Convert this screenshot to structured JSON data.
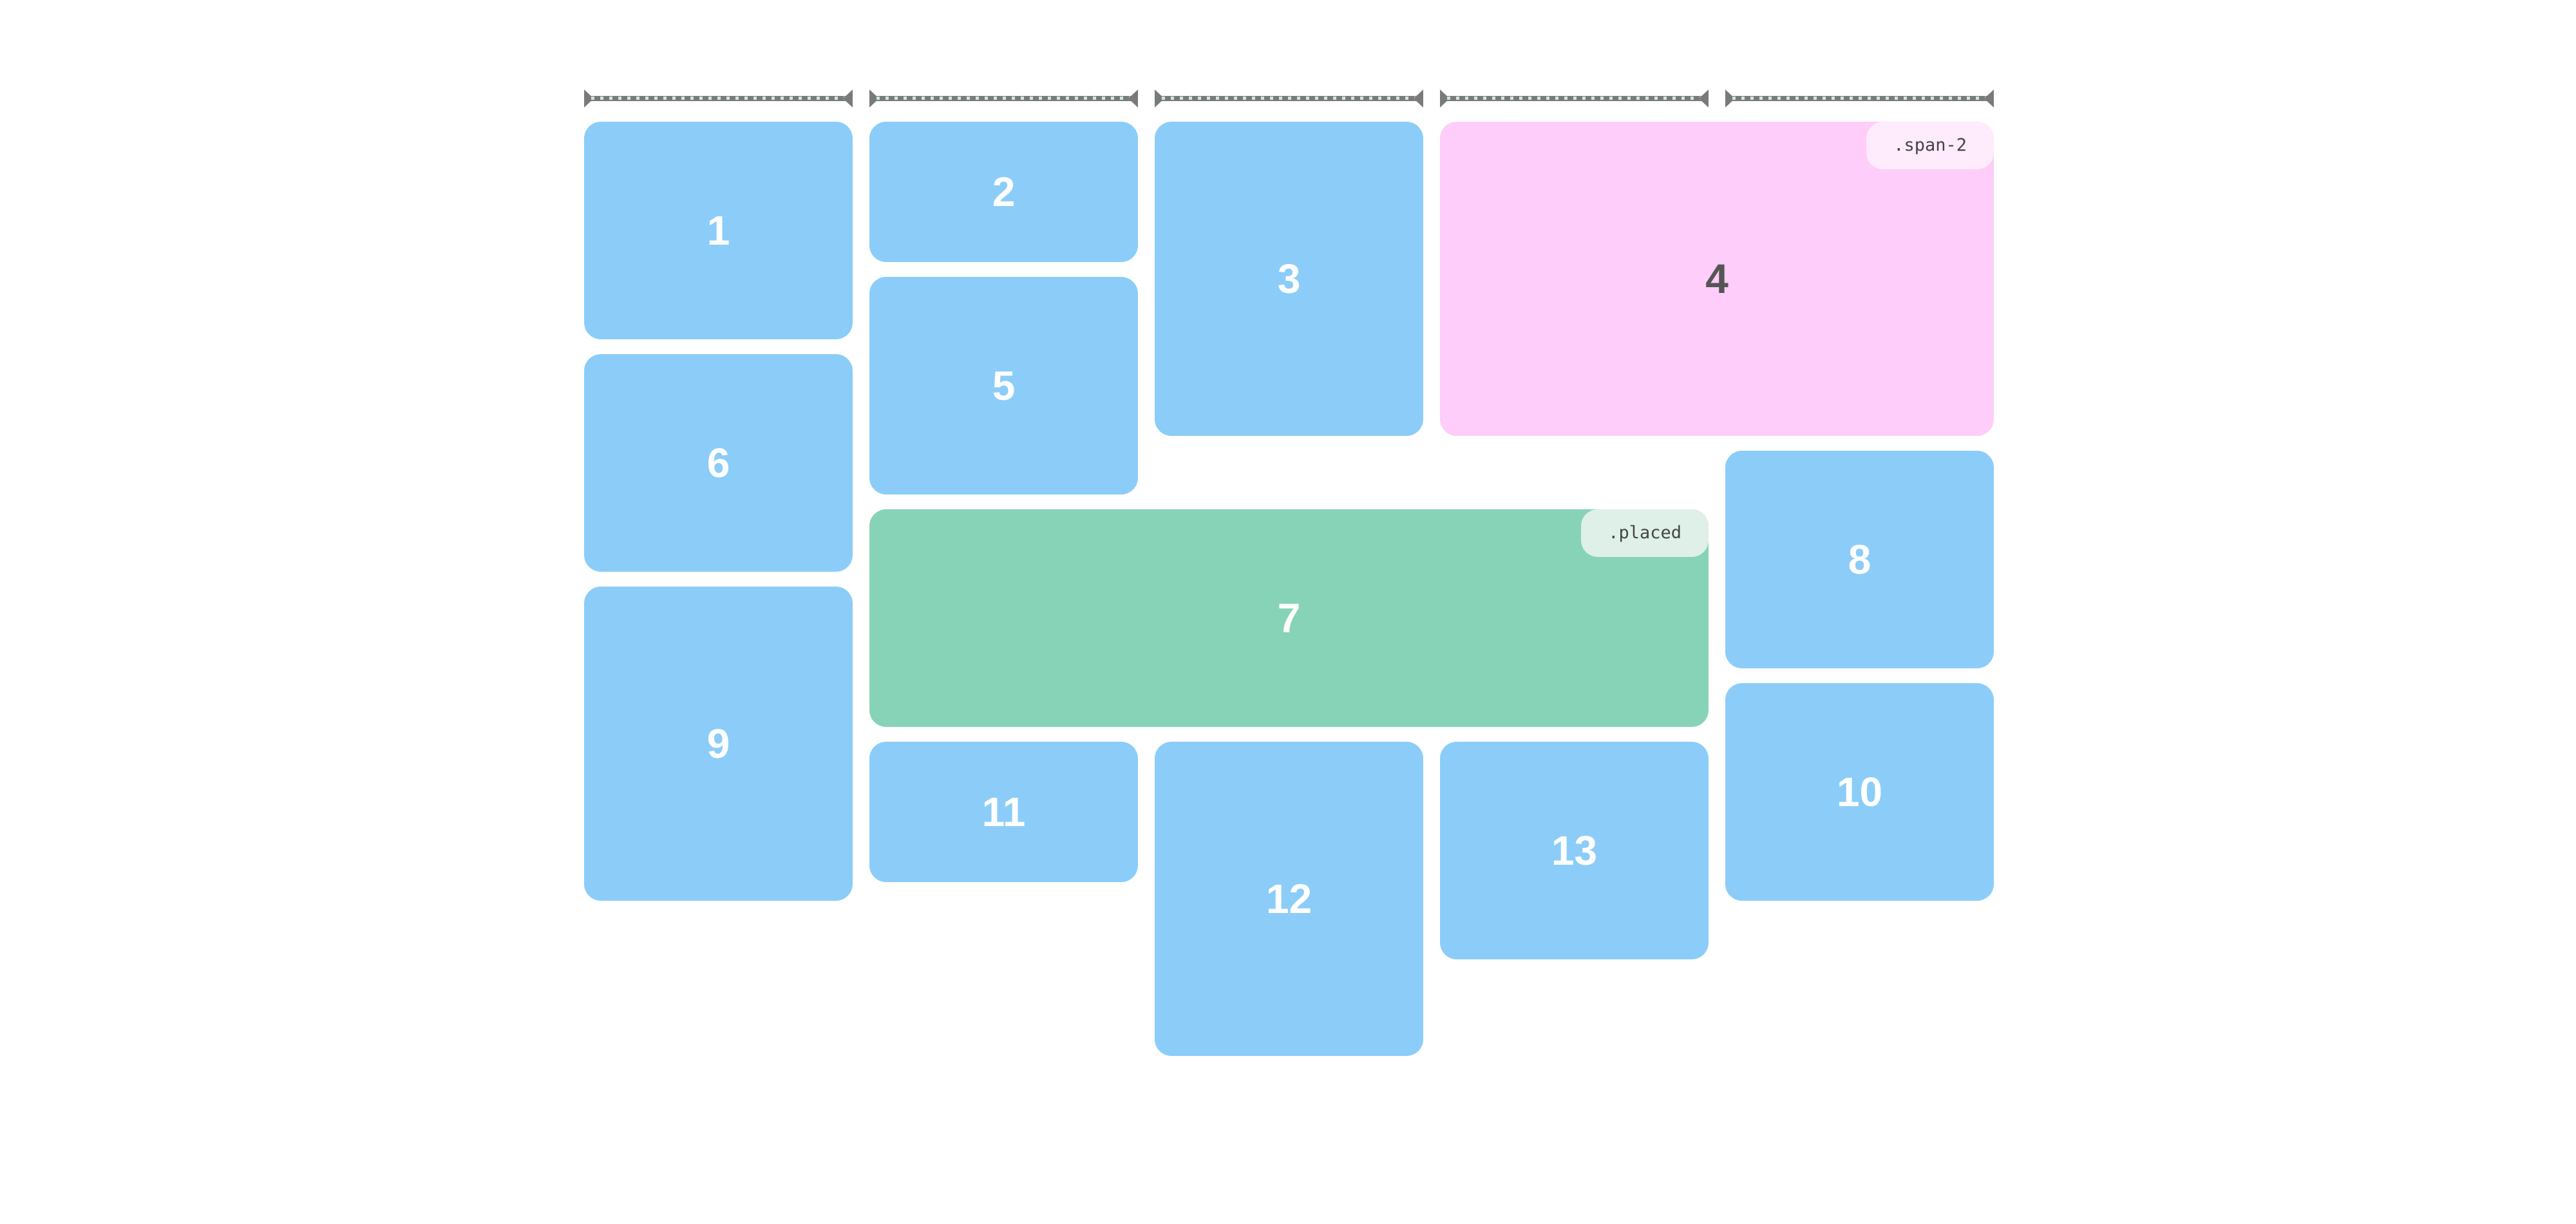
{
  "page": {
    "background": "#ffffff",
    "description": "CSS masonry grid layout demo with 13 numbered tiles and column width rulers"
  },
  "colors": {
    "item_blue": "#8bcdf8",
    "item_green": "#87d3b8",
    "item_pink": "#fecdf9",
    "badge_pink_bg": "#feebfc",
    "badge_mint_bg": "#def0e8",
    "badge_text": "#444444",
    "number_text": "#ffffff",
    "ruler_bar": "#7a7a7a",
    "ruler_dots": "#cde8df"
  },
  "ruler": {
    "segments": 5,
    "icon": "measure-arrow"
  },
  "items": [
    {
      "label": "1",
      "variant": "blue"
    },
    {
      "label": "2",
      "variant": "blue"
    },
    {
      "label": "3",
      "variant": "blue"
    },
    {
      "label": "4",
      "variant": "pink",
      "badge": ".span-2"
    },
    {
      "label": "5",
      "variant": "blue"
    },
    {
      "label": "6",
      "variant": "blue"
    },
    {
      "label": "7",
      "variant": "green",
      "badge": ".placed"
    },
    {
      "label": "8",
      "variant": "blue"
    },
    {
      "label": "9",
      "variant": "blue"
    },
    {
      "label": "10",
      "variant": "blue"
    },
    {
      "label": "11",
      "variant": "blue"
    },
    {
      "label": "12",
      "variant": "blue"
    },
    {
      "label": "13",
      "variant": "blue"
    }
  ]
}
